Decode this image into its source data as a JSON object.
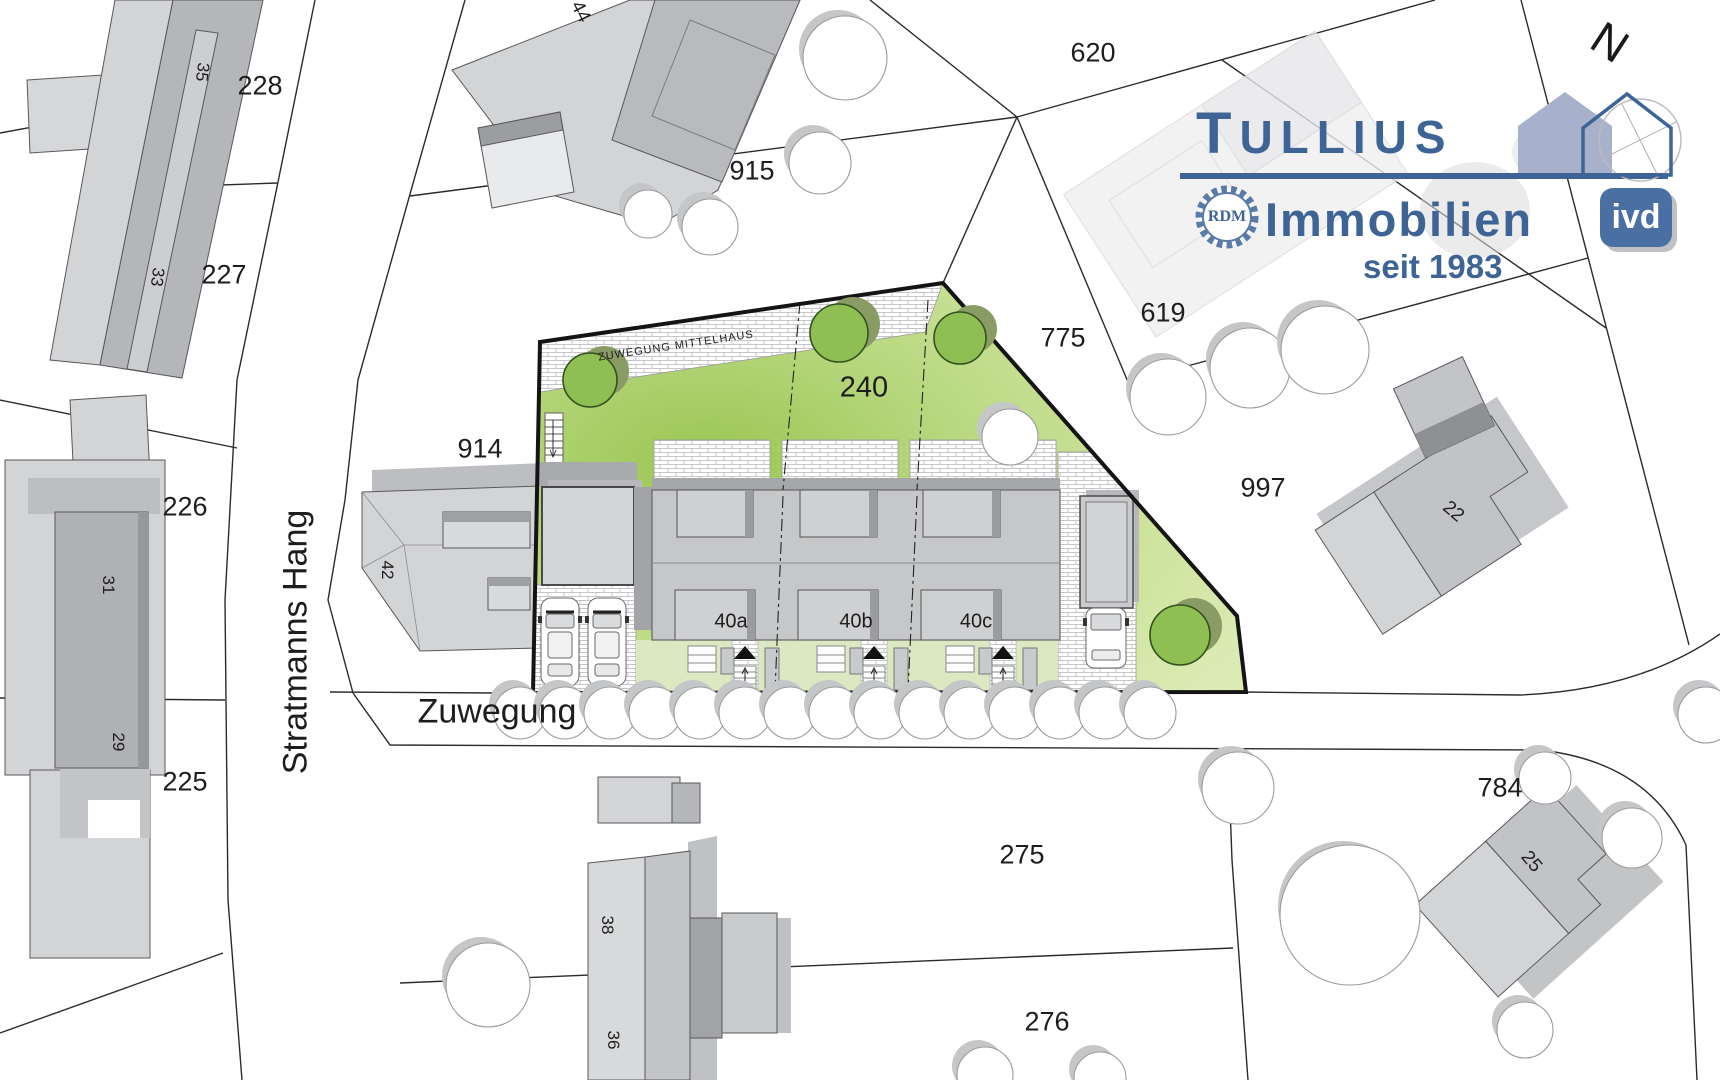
{
  "logo": {
    "brand_initial": "T",
    "brand_rest": "ULLIUS",
    "line2": "Immobilien",
    "since": "seit 1983",
    "seal": "RDM",
    "badge": "ivd",
    "accent": "#3e6496"
  },
  "compass": {
    "north": "N"
  },
  "streets": {
    "main": "Stratmanns Hang",
    "access": "Zuwegung",
    "path_note": "ZUWEGUNG MITTELHAUS"
  },
  "parcels": {
    "p228": "228",
    "p227": "227",
    "p226": "226",
    "p225": "225",
    "p914": "914",
    "p915": "915",
    "p620": "620",
    "p619": "619",
    "p775": "775",
    "p240": "240",
    "p997": "997",
    "p784": "784",
    "p275": "275",
    "p276": "276"
  },
  "houses": {
    "h35": "35",
    "h33": "33",
    "h31": "31",
    "h29": "29",
    "h44": "44",
    "h42": "42",
    "h38": "38",
    "h36": "36",
    "h22": "22",
    "h25": "25"
  },
  "units": {
    "a": "40a",
    "b": "40b",
    "c": "40c"
  },
  "colors": {
    "parcel_green": "#9cc857",
    "parcel_green_light": "#dcebb4",
    "yard_green": "#dce8c2",
    "building_light": "#d3d4d6",
    "building_mid": "#c2c3c6",
    "building_dark": "#a9aaad",
    "logo_blue": "#3e6496",
    "badge_blue": "#4a70a3",
    "house_icon_fill": "#a7b1cb"
  }
}
